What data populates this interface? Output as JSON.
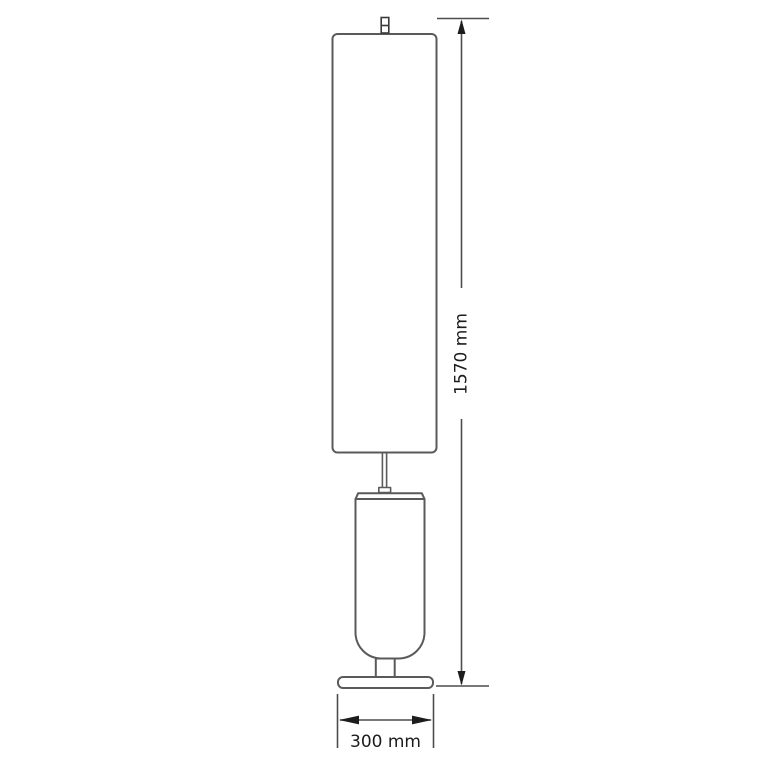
{
  "drawing": {
    "dimension_height": {
      "label": "1570 mm",
      "value": 1570,
      "unit": "mm",
      "orientation": "vertical"
    },
    "dimension_width": {
      "label": "300 mm",
      "value": 300,
      "unit": "mm",
      "orientation": "horizontal"
    },
    "colors": {
      "background": "#ffffff",
      "lamp_outline": "#5a5a5a",
      "detail_outline": "#3a3a3a",
      "dimension_line": "#4d4d4d",
      "arrow": "#1c1c1c",
      "text": "#1c1c1c"
    }
  }
}
